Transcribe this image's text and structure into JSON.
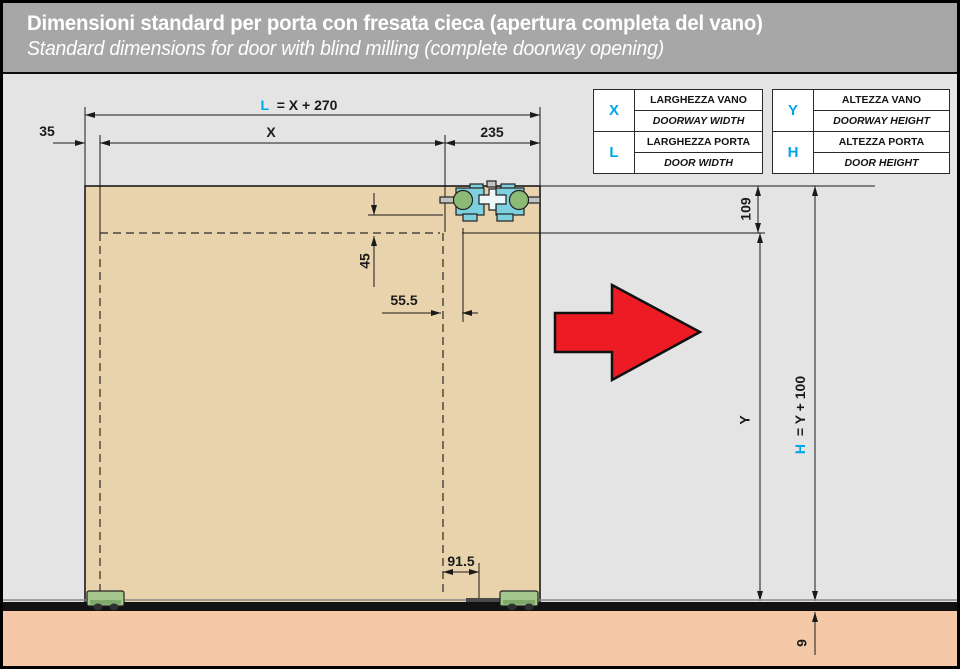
{
  "header": {
    "title_it": "Dimensioni standard per porta con fresata cieca (apertura completa del vano)",
    "title_en": "Standard dimensions for door with blind milling (complete doorway opening)"
  },
  "legend": {
    "width_table": {
      "rows": [
        {
          "symbol": "X",
          "it": "LARGHEZZA VANO",
          "en": "DOORWAY WIDTH"
        },
        {
          "symbol": "L",
          "it": "LARGHEZZA PORTA",
          "en": "DOOR WIDTH"
        }
      ]
    },
    "height_table": {
      "rows": [
        {
          "symbol": "Y",
          "it": "ALTEZZA VANO",
          "en": "DOORWAY HEIGHT"
        },
        {
          "symbol": "H",
          "it": "ALTEZZA PORTA",
          "en": "DOOR HEIGHT"
        }
      ]
    }
  },
  "dimensions": {
    "left_offset": "35",
    "door_width_symbol": "L",
    "door_width_formula": "= X + 270",
    "doorway_width": "X",
    "right_offset": "235",
    "top_inset": "109",
    "carriage_vertical": "45",
    "carriage_horizontal": "55.5",
    "floor_guide_offset": "91.5",
    "doorway_height": "Y",
    "door_height_symbol": "H",
    "door_height_formula": "= Y + 100",
    "floor_recess": "9"
  },
  "colors": {
    "accent_cyan": "#00a6e8",
    "arrow_red": "#ed1c24",
    "door_panel": "#e9d3ac",
    "floor": "#f5c9a8",
    "hardware_blue": "#7fd0df",
    "hardware_green": "#8cba77",
    "guide_green": "#a3c78c"
  }
}
